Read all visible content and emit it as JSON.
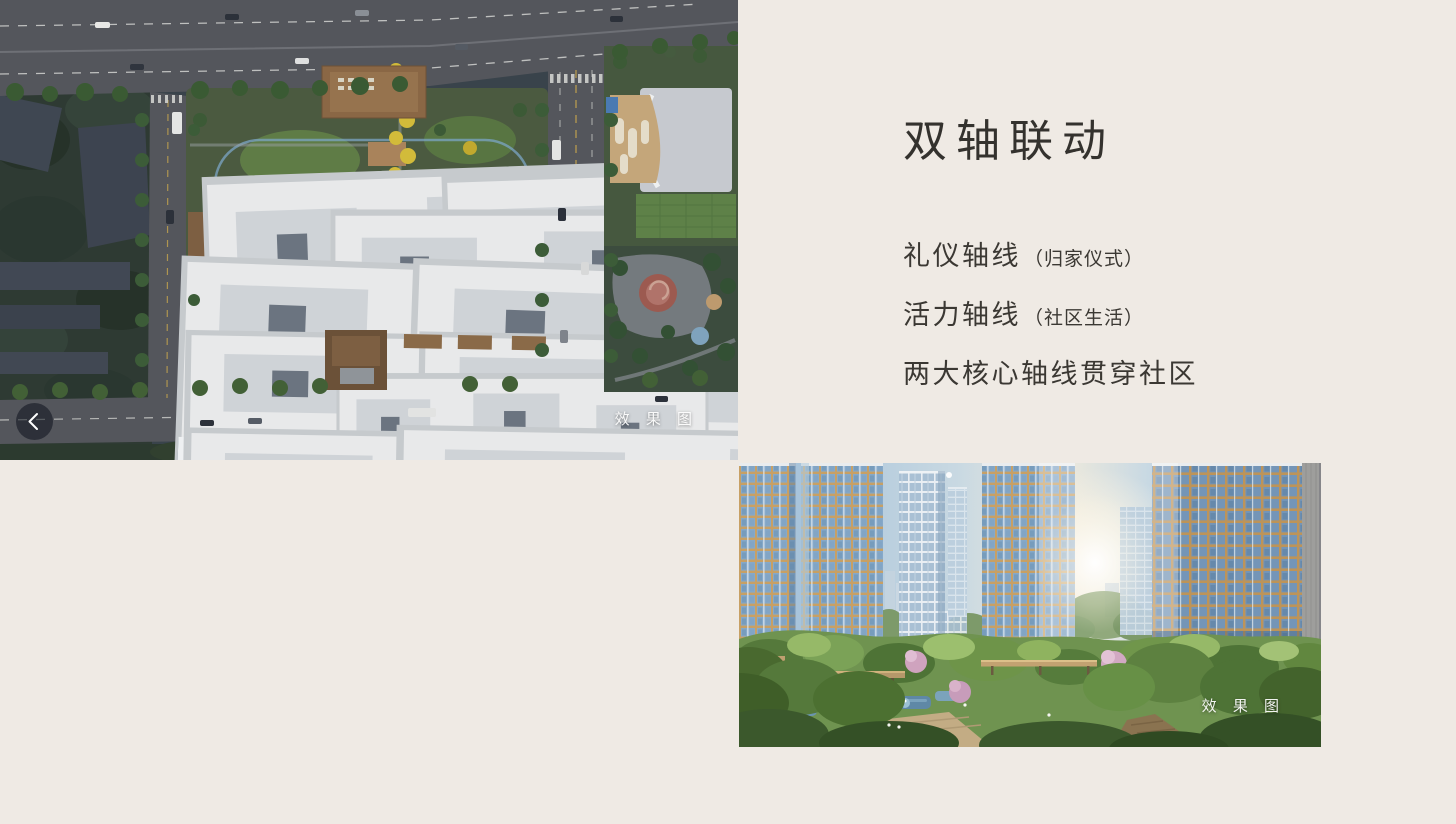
{
  "page": {
    "background_color": "#efeae4",
    "text_color": "#3b3833"
  },
  "carousel": {
    "prev_icon": "chevron-left"
  },
  "slide": {
    "title": "双轴联动",
    "points": [
      {
        "main": "礼仪轴线",
        "note": "（归家仪式）"
      },
      {
        "main": "活力轴线",
        "note": "（社区生活）"
      },
      {
        "main": "两大核心轴线贯穿社区",
        "note": ""
      }
    ]
  },
  "aerial_image": {
    "watermark": "效 果 图"
  },
  "perspective_image": {
    "watermark": "效 果 图"
  }
}
